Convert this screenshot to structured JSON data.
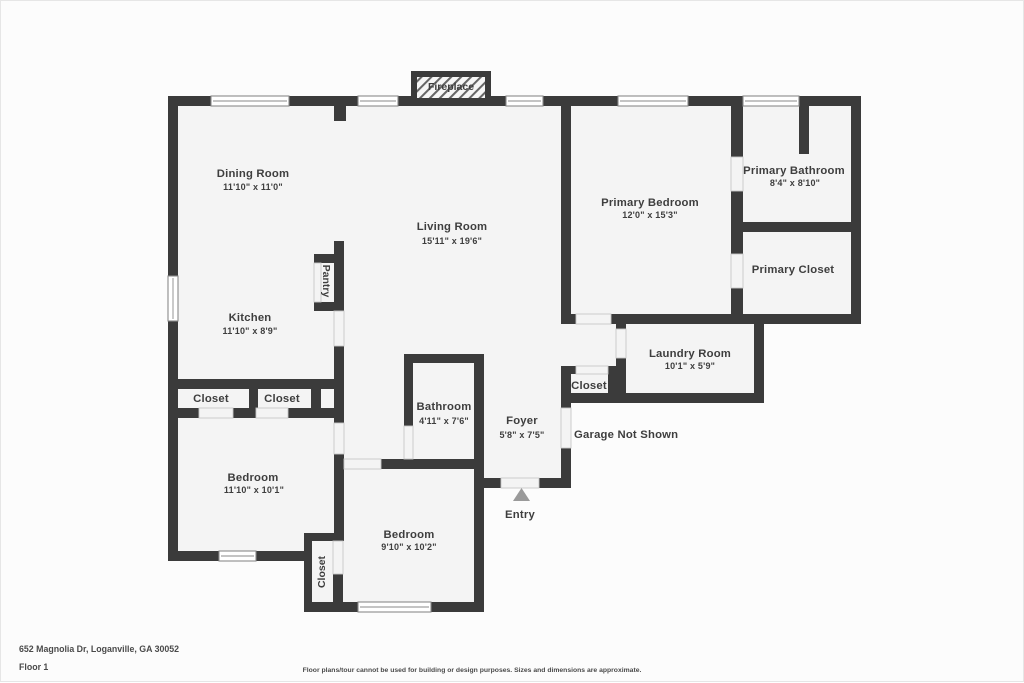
{
  "colors": {
    "wall": "#3b3b3b",
    "floor": "#f4f4f4",
    "window_frame": "#8a8a8a",
    "door_frame": "#c8c8c8",
    "label": "#3e3e3e",
    "entry_arrow": "#9a9a9a",
    "footer_text": "#4a4a4a",
    "page_border": "#e6e6e6",
    "page_bg": "#fcfcfc"
  },
  "rooms": {
    "dining": {
      "name": "Dining Room",
      "dims": "11'10\" x 11'0\""
    },
    "living": {
      "name": "Living Room",
      "dims": "15'11\" x 19'6\""
    },
    "kitchen": {
      "name": "Kitchen",
      "dims": "11'10\" x 8'9\""
    },
    "pantry": {
      "name": "Pantry"
    },
    "primary_bedroom": {
      "name": "Primary Bedroom",
      "dims": "12'0\" x 15'3\""
    },
    "primary_bathroom": {
      "name": "Primary Bathroom",
      "dims": "8'4\" x 8'10\""
    },
    "primary_closet": {
      "name": "Primary Closet"
    },
    "laundry": {
      "name": "Laundry Room",
      "dims": "10'1\" x 5'9\""
    },
    "hall_closet": {
      "name": "Closet"
    },
    "closet_1": {
      "name": "Closet"
    },
    "closet_2": {
      "name": "Closet"
    },
    "bedroom_closet": {
      "name": "Closet"
    },
    "bathroom": {
      "name": "Bathroom",
      "dims": "4'11\" x 7'6\""
    },
    "foyer": {
      "name": "Foyer",
      "dims": "5'8\" x 7'5\""
    },
    "bedroom_left": {
      "name": "Bedroom",
      "dims": "11'10\" x 10'1\""
    },
    "bedroom_bottom": {
      "name": "Bedroom",
      "dims": "9'10\" x 10'2\""
    }
  },
  "annotations": {
    "fireplace": "Fireplace",
    "entry": "Entry",
    "garage_note": "Garage Not Shown"
  },
  "footer": {
    "address": "652 Magnolia Dr, Loganville, GA 30052",
    "floor_label": "Floor 1",
    "disclaimer": "Floor plans/tour cannot be used for building or design purposes. Sizes and dimensions are approximate."
  }
}
